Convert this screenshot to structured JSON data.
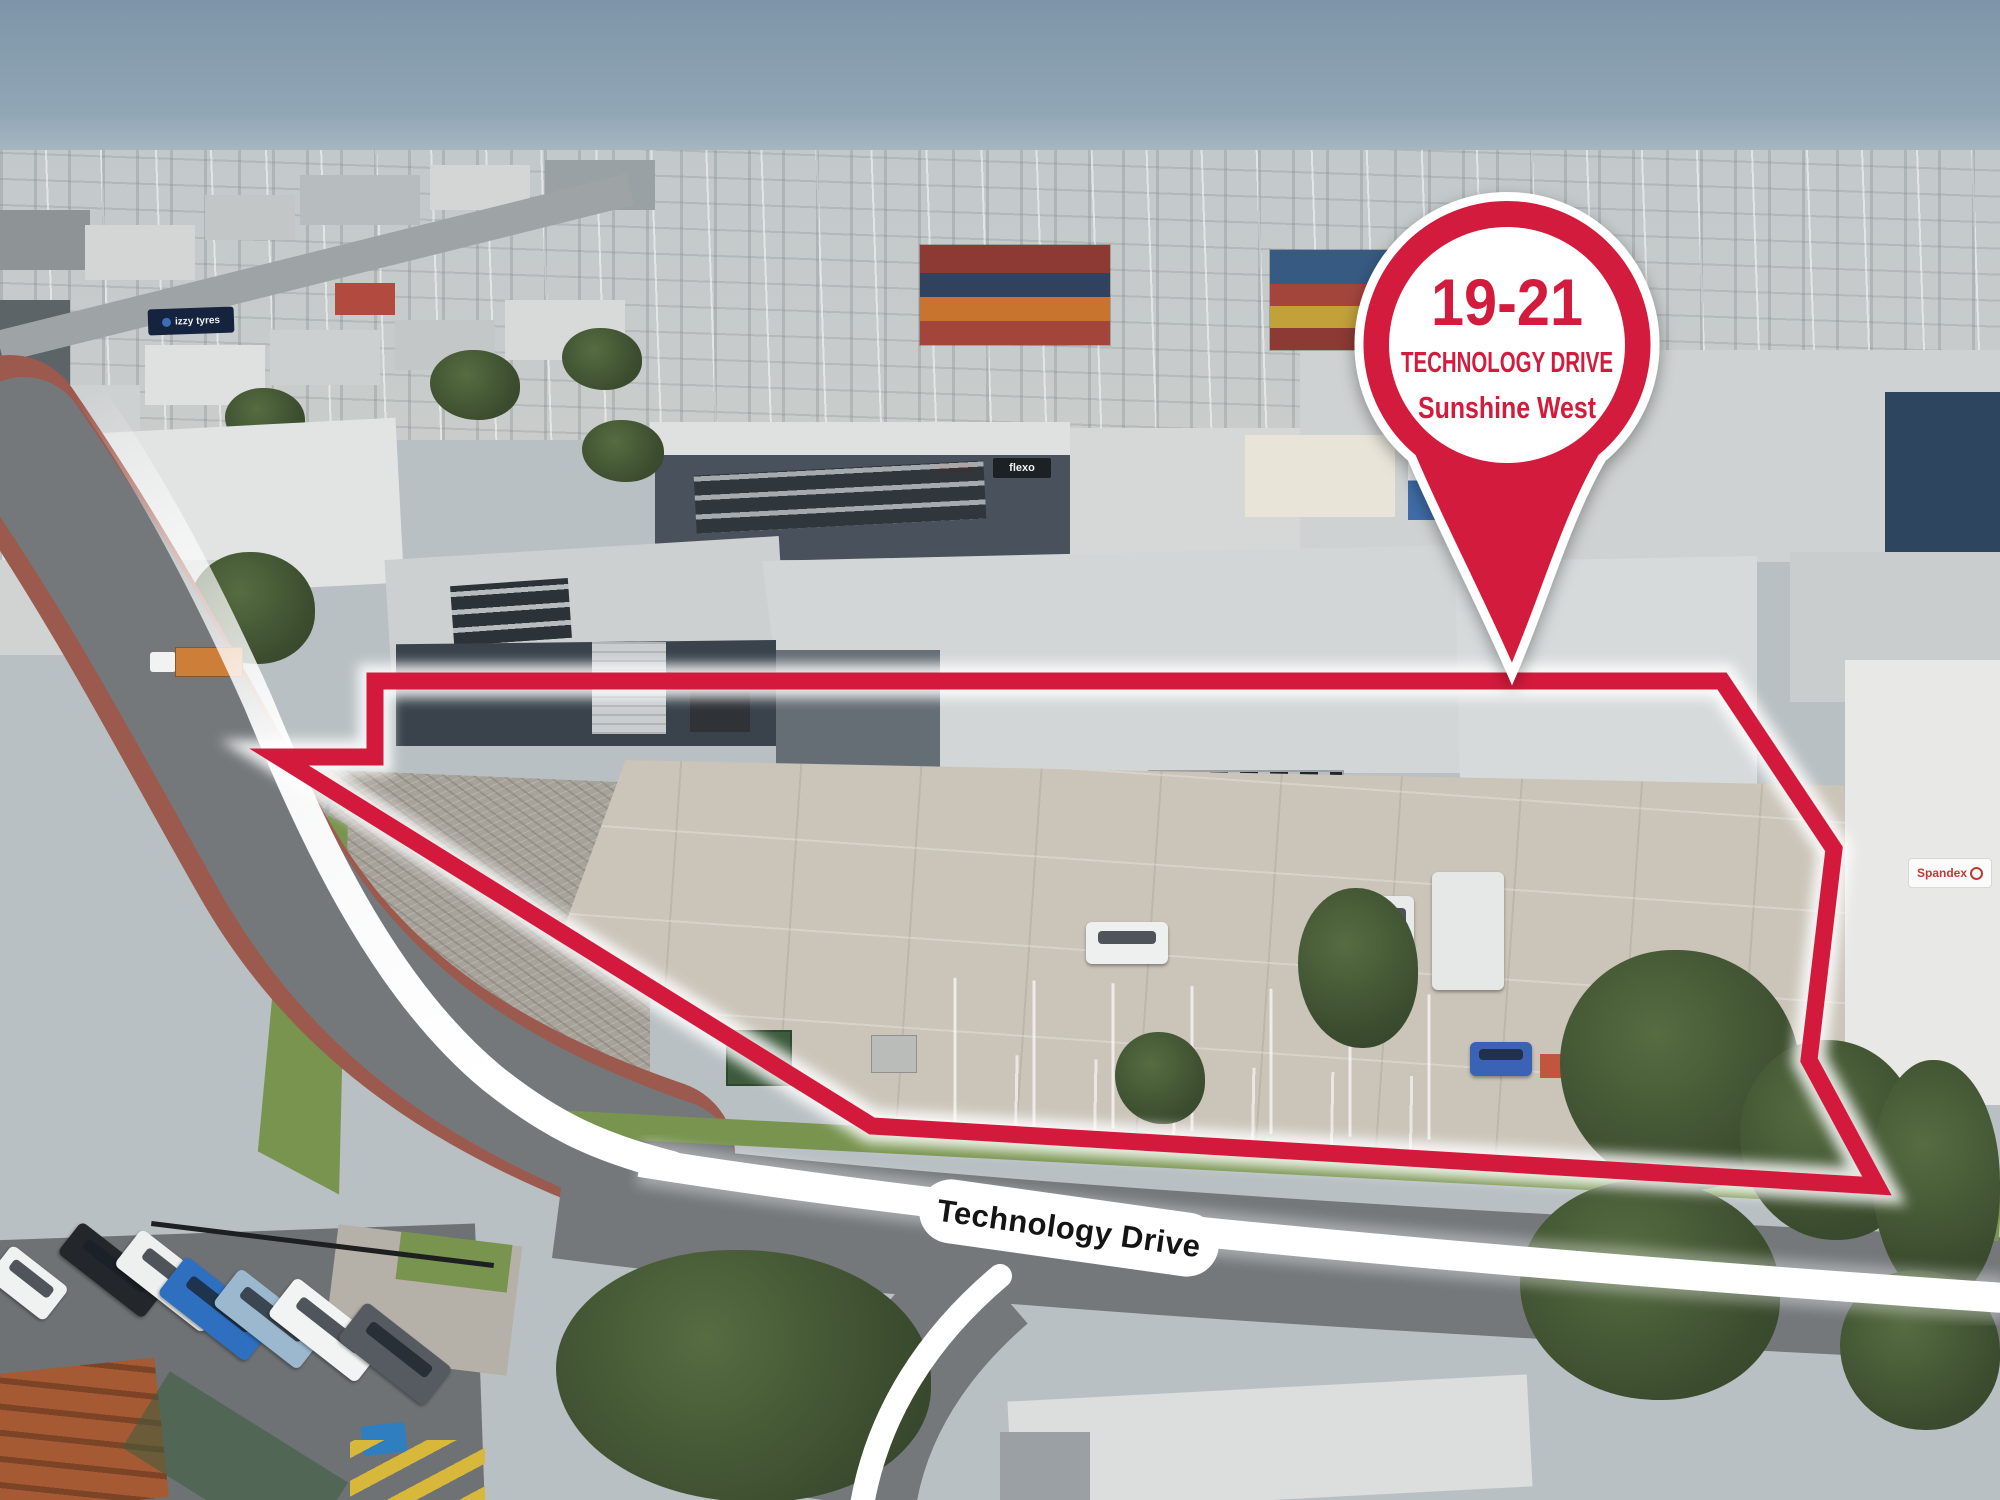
{
  "annotations": {
    "pin": {
      "line1": "19-21",
      "line2": "TECHNOLOGY DRIVE",
      "line3": "Sunshine West"
    },
    "road_label": "Technology Drive"
  },
  "signs": {
    "cornell_name": "CORNELL",
    "cornell_subtitle": "DIESEL SYSTEMS",
    "flexo": "flexo",
    "spandex": "Spandex",
    "izzy_tyres": "izzy tyres"
  },
  "colors": {
    "accent-red": "#d31a3c",
    "route-white": "#ffffff",
    "cornell-blue": "#283a8c",
    "spandex-red": "#c03a34",
    "asphalt": "#74787b",
    "bike-path-red": "#9c5a4e"
  }
}
